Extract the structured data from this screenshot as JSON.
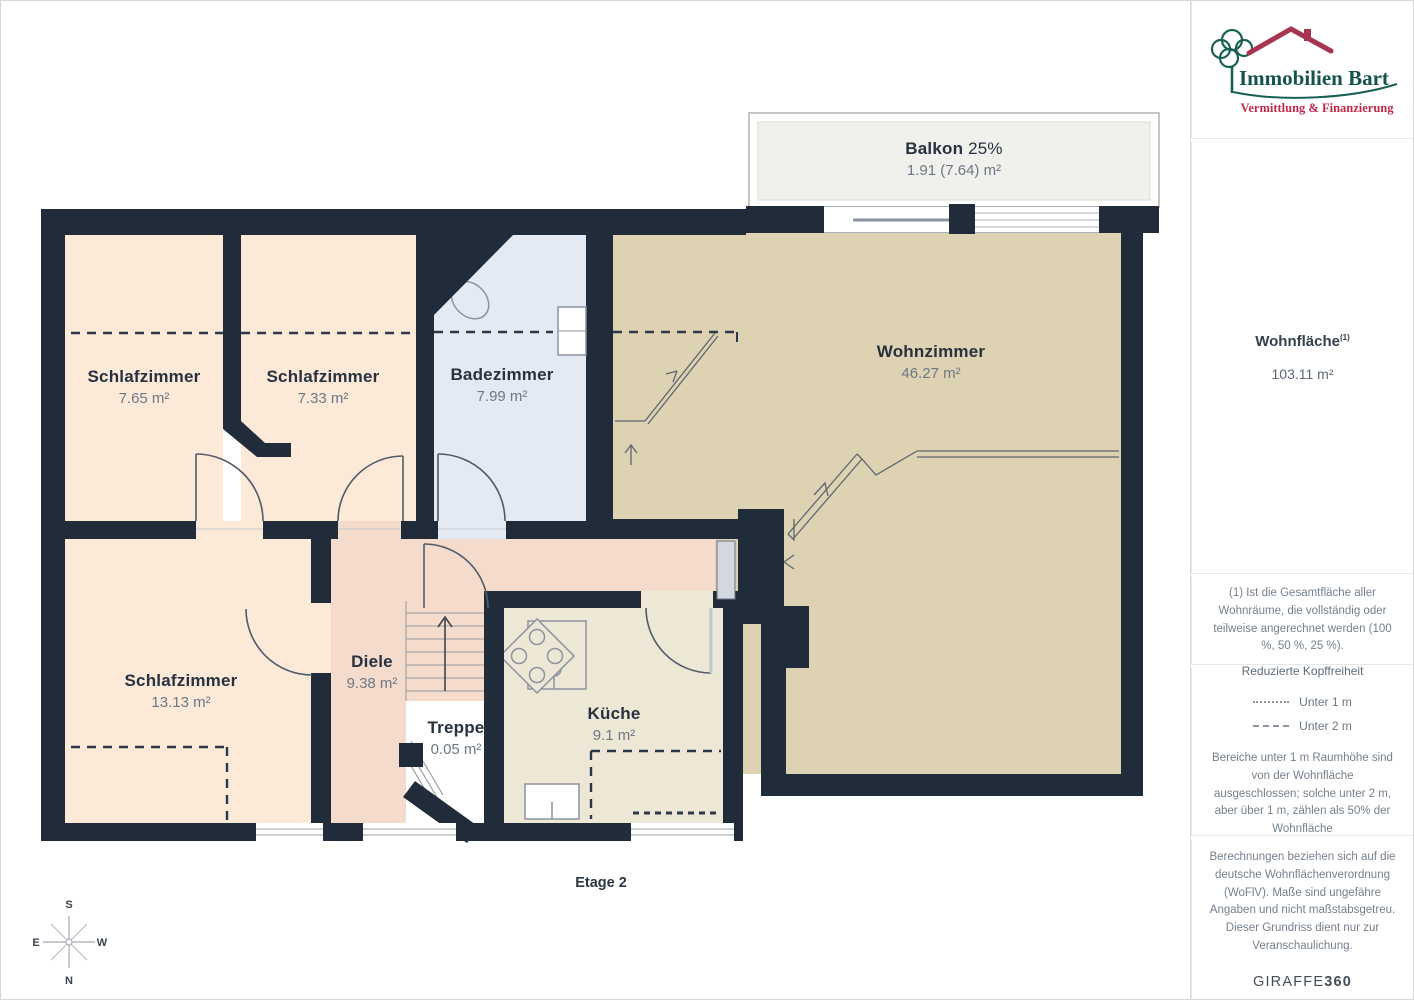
{
  "plan": {
    "floor_label": "Etage 2",
    "balcony": {
      "name": "Balkon",
      "percent": "25%",
      "area": "1.91 (7.64) m²"
    },
    "rooms": [
      {
        "name": "Schlafzimmer",
        "area": "7.65 m²"
      },
      {
        "name": "Schlafzimmer",
        "area": "7.33 m²"
      },
      {
        "name": "Badezimmer",
        "area": "7.99 m²"
      },
      {
        "name": "Wohnzimmer",
        "area": "46.27 m²"
      },
      {
        "name": "Schlafzimmer",
        "area": "13.13 m²"
      },
      {
        "name": "Diele",
        "area": "9.38 m²"
      },
      {
        "name": "Treppe",
        "area": "0.05 m²"
      },
      {
        "name": "Küche",
        "area": "9.1 m²"
      }
    ],
    "compass": {
      "n": "N",
      "s": "S",
      "e": "E",
      "w": "W"
    }
  },
  "sidebar": {
    "logo": {
      "brand": "Immobilien Bart",
      "tagline": "Vermittlung & Finanzierung"
    },
    "area_summary": {
      "title": "Wohnfläche",
      "sup": "(1)",
      "value": "103.11 m²"
    },
    "footnote": "(1) Ist die Gesamtfläche aller Wohnräume, die vollständig oder teilweise angerechnet werden (100 %, 50 %, 25 %).",
    "legend": {
      "title": "Reduzierte Kopffreiheit",
      "items": [
        {
          "style": "dotted",
          "label": "Unter 1 m"
        },
        {
          "style": "dashed",
          "label": "Unter 2 m"
        }
      ],
      "note": "Bereiche unter 1 m Raumhöhe sind von der Wohnfläche ausgeschlossen; solche unter 2 m, aber über 1 m, zählen als 50% der Wohnfläche"
    },
    "disclaimer": "Berechnungen beziehen sich auf die deutsche Wohnflächenverordnung (WoFlV). Maße sind ungefähre Angaben und nicht maßstabsgetreu. Dieser Grundriss dient nur zur Veranschaulichung.",
    "brand_footer": {
      "giraffe": "GIRAFFE",
      "threesixty": "360"
    }
  },
  "colors": {
    "wall": "#212c3a",
    "bedroom_fill": "#fce9d8",
    "bath_fill": "#e4eaf4",
    "living_fill": "#ddd2b2",
    "hall_fill": "#f5dbcc",
    "kitchen_fill": "#ede7d5",
    "balcony_fill": "#f0f0ed",
    "logo_teal": "#1a6155",
    "logo_red": "#a73450"
  }
}
